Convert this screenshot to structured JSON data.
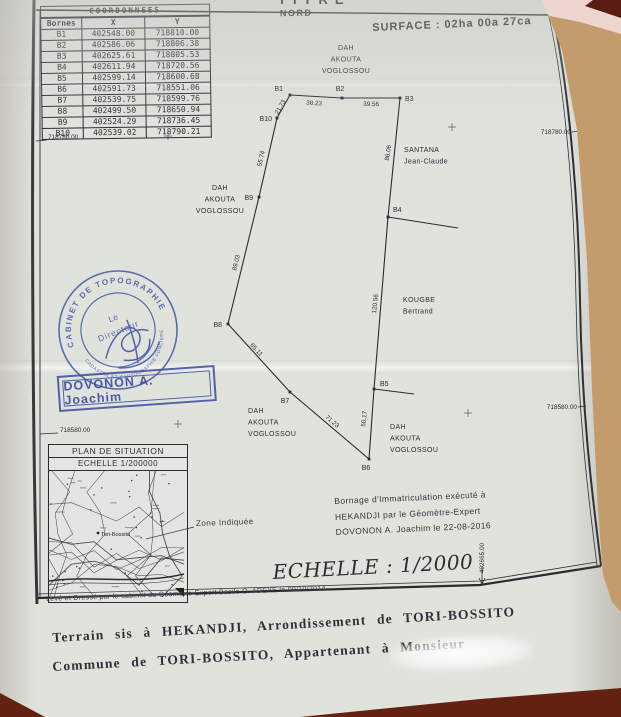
{
  "palette": {
    "tan": "#c49b6c",
    "pink": "#ecd6cf",
    "maroon": "#63220f",
    "paper": "#e0e3dc",
    "ink": "#2a2b30",
    "stamp_blue": "#3f50a3"
  },
  "header": {
    "clipped_title": "TITRE",
    "north_label": "NORD",
    "surface_label": "SURFACE :  02ha 00a 27ca"
  },
  "coords_table": {
    "title": "COORDONNEES",
    "col_bornes": "Bornes",
    "col_x": "X",
    "col_y": "Y",
    "rows": [
      [
        "B1",
        "402548.00",
        "718810.00"
      ],
      [
        "B2",
        "402586.06",
        "718806.38"
      ],
      [
        "B3",
        "402625.61",
        "718805.53"
      ],
      [
        "B4",
        "402611.94",
        "718720.56"
      ],
      [
        "B5",
        "402599.14",
        "718600.68"
      ],
      [
        "B6",
        "402591.73",
        "718551.06"
      ],
      [
        "B7",
        "402539.75",
        "718599.76"
      ],
      [
        "B8",
        "402499.50",
        "718650.94"
      ],
      [
        "B9",
        "402524.29",
        "718736.45"
      ],
      [
        "B10",
        "402539.02",
        "718790.21"
      ]
    ]
  },
  "plan": {
    "points": [
      {
        "id": "B1",
        "x": 290,
        "y": 95,
        "lx": 283,
        "ly": 91,
        "anchor": "end"
      },
      {
        "id": "B2",
        "x": 342,
        "y": 98,
        "lx": 340,
        "ly": 91,
        "anchor": "middle"
      },
      {
        "id": "B3",
        "x": 400,
        "y": 98,
        "lx": 405,
        "ly": 101,
        "anchor": "start"
      },
      {
        "id": "B4",
        "x": 388,
        "y": 217,
        "lx": 393,
        "ly": 212,
        "anchor": "start"
      },
      {
        "id": "B5",
        "x": 374,
        "y": 389,
        "lx": 380,
        "ly": 386,
        "anchor": "start"
      },
      {
        "id": "B6",
        "x": 369,
        "y": 459,
        "lx": 366,
        "ly": 470,
        "anchor": "middle"
      },
      {
        "id": "B7",
        "x": 290,
        "y": 392,
        "lx": 285,
        "ly": 403,
        "anchor": "middle"
      },
      {
        "id": "B8",
        "x": 228,
        "y": 324,
        "lx": 222,
        "ly": 327,
        "anchor": "end"
      },
      {
        "id": "B9",
        "x": 259,
        "y": 197,
        "lx": 253,
        "ly": 200,
        "anchor": "end"
      },
      {
        "id": "B10",
        "x": 277,
        "y": 118,
        "lx": 272,
        "ly": 121,
        "anchor": "end"
      }
    ],
    "segments": [
      {
        "a": 0,
        "b": 1,
        "label": "38.23",
        "lx": 314,
        "ly": 105,
        "rot": 4
      },
      {
        "a": 1,
        "b": 2,
        "label": "39.56",
        "lx": 371,
        "ly": 106,
        "rot": 2
      },
      {
        "a": 2,
        "b": 3,
        "label": "86.06",
        "lx": 390,
        "ly": 153,
        "rot": -81
      },
      {
        "a": 3,
        "b": 4,
        "label": "120.56",
        "lx": 377,
        "ly": 304,
        "rot": -84
      },
      {
        "a": 4,
        "b": 5,
        "label": "50.17",
        "lx": 366,
        "ly": 419,
        "rot": -84
      },
      {
        "a": 5,
        "b": 6,
        "label": "71.23",
        "lx": 331,
        "ly": 423,
        "rot": 40
      },
      {
        "a": 6,
        "b": 7,
        "label": "65.11",
        "lx": 255,
        "ly": 351,
        "rot": 47
      },
      {
        "a": 7,
        "b": 8,
        "label": "89.03",
        "lx": 238,
        "ly": 263,
        "rot": -77
      },
      {
        "a": 8,
        "b": 9,
        "label": "55.74",
        "lx": 263,
        "ly": 159,
        "rot": -77
      },
      {
        "a": 9,
        "b": 0,
        "label": "21.73",
        "lx": 282,
        "ly": 108,
        "rot": -60
      }
    ],
    "extensions": [
      [
        388,
        217,
        458,
        228
      ],
      [
        374,
        389,
        414,
        394
      ]
    ],
    "leader": [
      194,
      527,
      146,
      539
    ],
    "neighbors": [
      {
        "lines": [
          "DAH",
          "AKOUTA",
          "VOGLOSSOU"
        ],
        "x": 346,
        "y": 50,
        "anchor": "middle"
      },
      {
        "lines": [
          "SANTANA",
          "Jean-Claude"
        ],
        "x": 404,
        "y": 152,
        "anchor": "start"
      },
      {
        "lines": [
          "DAH",
          "AKOUTA",
          "VOGLOSSOU"
        ],
        "x": 220,
        "y": 190,
        "anchor": "middle"
      },
      {
        "lines": [
          "KOUGBE",
          "Bertrand"
        ],
        "x": 403,
        "y": 302,
        "anchor": "start"
      },
      {
        "lines": [
          "DAH",
          "AKOUTA",
          "VOGLOSSOU"
        ],
        "x": 248,
        "y": 413,
        "anchor": "start"
      },
      {
        "lines": [
          "DAH",
          "AKOUTA",
          "VOGLOSSOU"
        ],
        "x": 390,
        "y": 429,
        "anchor": "start"
      }
    ],
    "grid_labels": [
      {
        "text": "718780.00",
        "x": 48,
        "y": 139,
        "anchor": "start",
        "tick": [
          36,
          141,
          47,
          140
        ]
      },
      {
        "text": "718780.00",
        "x": 571,
        "y": 134,
        "anchor": "end",
        "tick": [
          572,
          132,
          580,
          131
        ]
      },
      {
        "text": "718580.00",
        "x": 60,
        "y": 432,
        "anchor": "start",
        "tick": [
          40,
          434,
          58,
          433
        ]
      },
      {
        "text": "718580.00",
        "x": 577,
        "y": 409,
        "anchor": "end",
        "tick": [
          578,
          407,
          586,
          406
        ]
      }
    ],
    "bottom_grid_label": {
      "text": "402665.00",
      "x": 484,
      "y": 558,
      "tick": [
        482,
        566,
        482,
        583
      ]
    },
    "crosses": [
      [
        168,
        136
      ],
      [
        452,
        127
      ],
      [
        178,
        424
      ],
      [
        468,
        413
      ]
    ]
  },
  "stamps": {
    "round_top": "CABINET DE TOPOGRAPHIE",
    "round_bottom": "CADASTRE ET CARTOGRAPHIE FONCIERE",
    "round_center_line1": "Le",
    "round_center_line2": "Directeur",
    "name_stamp": "DOVONON A. Joachim"
  },
  "situation": {
    "title": "PLAN DE SITUATION",
    "scale": "ECHELLE  1/200000",
    "map_label": "Tori-Bossito",
    "zone_label": "Zone Indiquée"
  },
  "notes": {
    "bornage_line1": "Bornage d'Immatriculation exécuté à",
    "bornage_line2": "HEKANDJI par le Géomètre-Expert",
    "bornage_line3": "DOVONON A. Joachim le 22-08-2016",
    "scale_text": "ECHELLE : 1/2000"
  },
  "footer": {
    "credit": "Levé et Dressé par le cabinet du Géomètre-Expert Basile O. ADEYE   le 09/10/2014",
    "line1": "Terrain sis à HEKANDJI, Arrondissement de TORI-BOSSITO",
    "line2": "Commune de TORI-BOSSITO, Appartenant à Monsieur"
  }
}
